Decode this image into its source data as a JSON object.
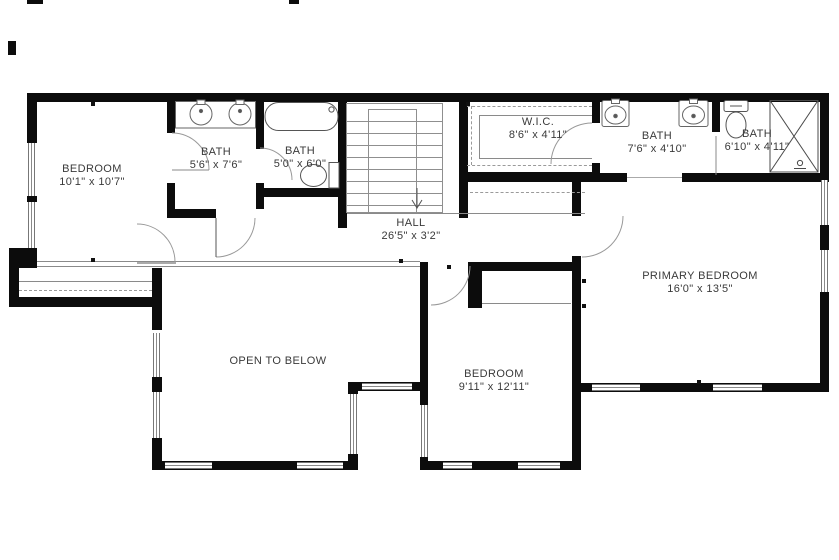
{
  "rooms": {
    "bedroom1": {
      "name": "BEDROOM",
      "dims": "10'1\" x 10'7\""
    },
    "bath_a": {
      "name": "BATH",
      "dims": "5'6\" x 7'6\""
    },
    "bath_b": {
      "name": "BATH",
      "dims": "5'0\" x 6'0\""
    },
    "wic": {
      "name": "W.I.C.",
      "dims": "8'6\" x 4'11\""
    },
    "bath_c": {
      "name": "BATH",
      "dims": "7'6\" x 4'10\""
    },
    "bath_d": {
      "name": "BATH",
      "dims": "6'10\" x 4'11\""
    },
    "hall": {
      "name": "HALL",
      "dims": "26'5\" x 3'2\""
    },
    "primary_bedroom": {
      "name": "PRIMARY BEDROOM",
      "dims": "16'0\" x 13'5\""
    },
    "open_to_below": {
      "name": "OPEN TO BELOW",
      "dims": ""
    },
    "bedroom2": {
      "name": "BEDROOM",
      "dims": "9'11\" x 12'11\""
    }
  },
  "fixtures": [
    "double-sink-vanity",
    "bathtub",
    "toilet",
    "staircase",
    "double-sink",
    "toilet",
    "shower"
  ],
  "colors": {
    "wall": "#0c0c0c",
    "thin_line": "#8a8a8a",
    "text": "#3a3a3a",
    "background": "#ffffff"
  }
}
